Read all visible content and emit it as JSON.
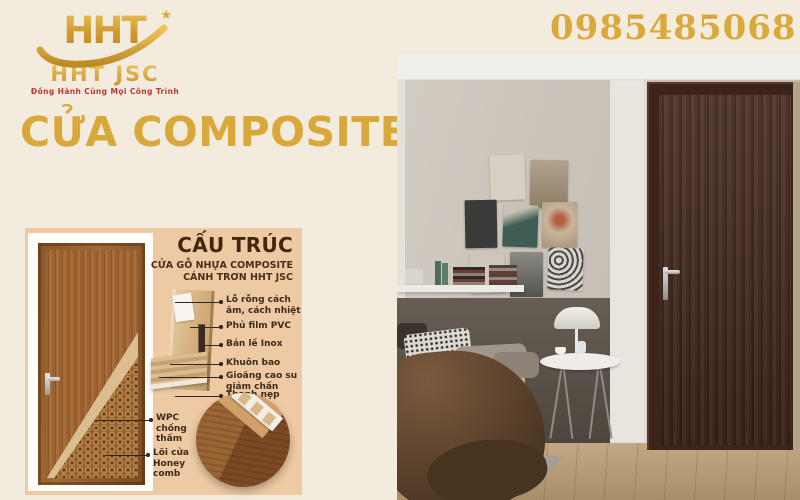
{
  "header": {
    "logo": {
      "brand": "HHT",
      "brand_sub": "HHT JSC",
      "tagline": "Đồng Hành Cùng Mọi Công Trình",
      "star_icon": "★"
    },
    "phone": "0985485068"
  },
  "title": "CỬA COMPOSITE",
  "diagram": {
    "title": "CẤU TRÚC",
    "subtitle_line1": "CỬA GỖ NHỰA COMPOSITE",
    "subtitle_line2": "CÁNH TRƠN HHT JSC",
    "labels": [
      {
        "text": "Lỗ rỗng cách âm, cách nhiệt"
      },
      {
        "text": "Phủ film PVC"
      },
      {
        "text": "Bản lề Inox"
      },
      {
        "text": "Khuôn bao"
      },
      {
        "text": "Gioăng cao su giảm chấn"
      },
      {
        "text": "Thanh nẹp"
      }
    ],
    "bottom_labels": [
      {
        "text": "WPC chống thấm"
      },
      {
        "text": "Lõi cửa Honey comb"
      }
    ]
  },
  "colors": {
    "background_cream": "#f4ebdf",
    "accent_gold": "#d9a93c",
    "tagline_red": "#c0362b",
    "panel_peach": "#edc9a4",
    "diagram_text_brown": "#42260e",
    "photo_door_brown": "#3c241a"
  }
}
